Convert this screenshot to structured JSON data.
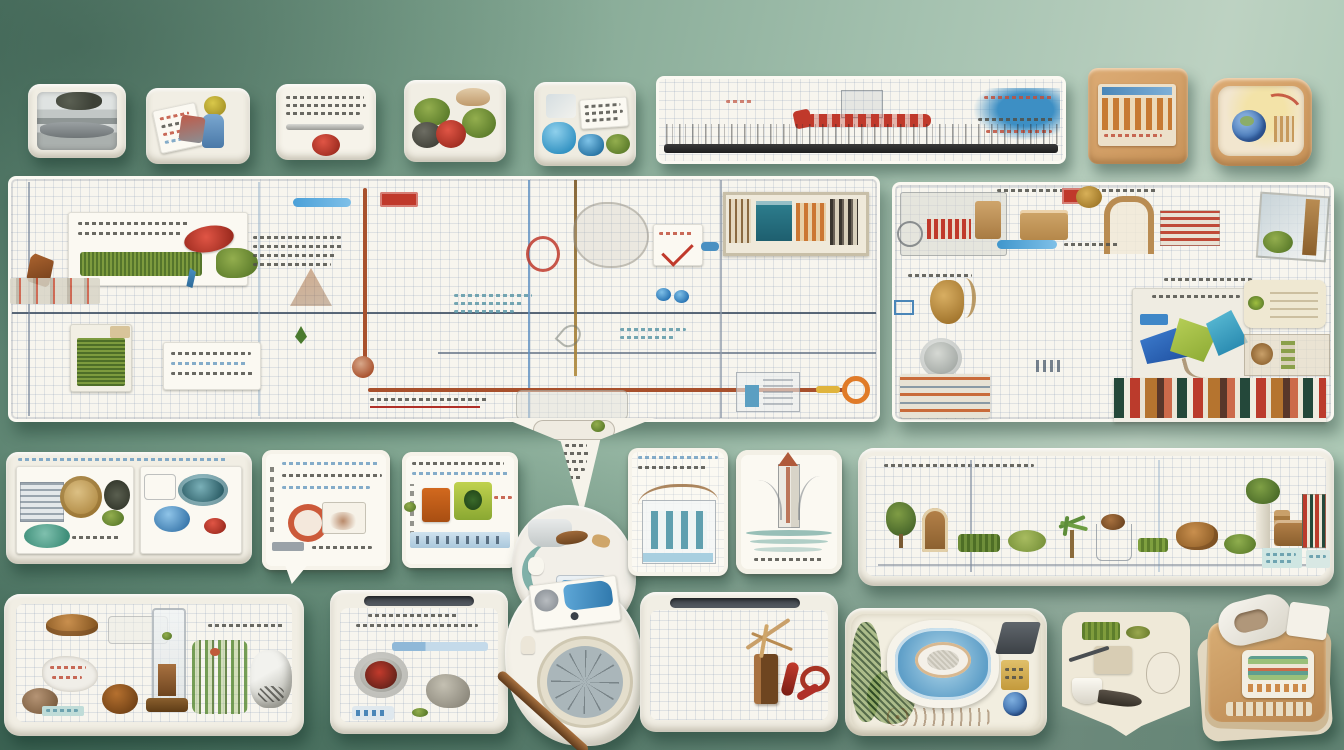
{
  "scene": {
    "type": "photographic still-life collage",
    "description": "White graph-paper boards and small display trays mounted on a sage-green wall; each tray holds miniature objects, moss, sketches and illegible printed gibberish text.",
    "background_colors": {
      "top_left": "#577e6c",
      "center": "#8fb29e",
      "right": "#bdd2c2",
      "bottom_shade": "#3f7561"
    },
    "legible_text": "none — all printed text in the photo is illegible gibberish"
  },
  "palette": {
    "paper": "#f7f5ee",
    "grid_line": "#aebdd4",
    "tray_rim": "#f1eee4",
    "tan_tray": "#d2a066",
    "accent_red": "#c0392b",
    "accent_rust": "#a8502c",
    "accent_blue": "#3f8fc4",
    "accent_navy": "#3e4f63",
    "accent_teal": "#2e7f8f",
    "moss_green": "#6e8e3a",
    "leaf_green": "#9fbf3f",
    "wood_brown": "#8a5a32"
  },
  "top_row": {
    "items": [
      {
        "name": "tray-stacked-prints",
        "description": "small white tray with a stack of grey newspaper-like prints and dark treetop imagery"
      },
      {
        "name": "tray-color-cards",
        "description": "white tray holding tilted colorful cards, a yellow tuft and a blue figurine"
      },
      {
        "name": "tray-note-red-ball",
        "description": "white tray with a printed gibberish note, a silver pen shape and a red yarn ball"
      },
      {
        "name": "tray-moss-cluster",
        "description": "white tray with green moss clumps, a red pom, a dark stone and a tan shell"
      },
      {
        "name": "tray-blue-crystals",
        "description": "white tray with blue crystal blobs, a labelled card of gibberish text and moss"
      },
      {
        "name": "ruler-board",
        "description": "long white grid board with red scribbles, a blue paint splash and a dark barcode strip"
      },
      {
        "name": "tan-tray-building",
        "description": "tan wooden tray showing an orange columned-building print with a blue header stripe"
      },
      {
        "name": "tan-tray-globe",
        "description": "tan rounded tray with a blue globe, yellow glow and red arcs"
      }
    ]
  },
  "main_board": {
    "left_panel": {
      "name": "graph-board-left",
      "description": "large white graph-paper board with navy rules, a rust-coloured pipe line, grass cards, printed gibberish blocks, sketches and a framed picture",
      "items": [
        {
          "name": "grass-card",
          "description": "white card with gibberish text, grass strip, red badge, moss fan and blue tassel"
        },
        {
          "name": "brown-bird",
          "description": "small brown bird-like shape at left edge"
        },
        {
          "name": "building-strip",
          "description": "faded strip of tiny building prints"
        },
        {
          "name": "text-block",
          "description": "block of illegible printed lines"
        },
        {
          "name": "blue-pill-marker",
          "description": "blue highlighted bar"
        },
        {
          "name": "red-stamp",
          "description": "small red stamped rectangle"
        },
        {
          "name": "grass-box",
          "description": "card with vertical green grass texture"
        },
        {
          "name": "text-card",
          "description": "white card with illegible printed lines"
        },
        {
          "name": "rust-pipe",
          "description": "rust-red pipe line running down then right with a knob and orange ring end"
        },
        {
          "name": "red-circle-sketch",
          "description": "hand-drawn red circle"
        },
        {
          "name": "tree-sketch",
          "description": "faint pencil tree sketch"
        },
        {
          "name": "speech-card",
          "description": "small card with red check scribble"
        },
        {
          "name": "framed-picture",
          "description": "framed collage with teal panel, orange figures and dark slats"
        },
        {
          "name": "blue-dots",
          "description": "two glossy blue paint dots"
        },
        {
          "name": "building-sketch",
          "description": "faint building outline with blue door"
        }
      ]
    },
    "pointer_tail": {
      "name": "board-pointer-tail",
      "description": "V-shaped paper tail hanging from the board bottom, filled with tiny sketches and a column of gibberish text"
    },
    "right_panel": {
      "name": "graph-board-right",
      "description": "second graph-paper board collaged with machine parts, boxes, a squirrel figure, a coin, geometric blue-green glass shards, shelves of tiny books and striped labels",
      "items": [
        {
          "name": "machine-collage",
          "description": "grey machine sketch with red grille"
        },
        {
          "name": "cardboard-box",
          "description": "small tan box"
        },
        {
          "name": "arch-frame",
          "description": "tan arched frame"
        },
        {
          "name": "striped-labels",
          "description": "red striped label cards"
        },
        {
          "name": "glass-moss-pane",
          "description": "tilted glass pane with green moss"
        },
        {
          "name": "gold-squirrel",
          "description": "small golden squirrel figure"
        },
        {
          "name": "grey-coin",
          "description": "round grey disc"
        },
        {
          "name": "striped-stack",
          "description": "stack of orange striped paper slips"
        },
        {
          "name": "geo-collage-card",
          "description": "card with cobalt, lime and teal triangular glass shards and gibberish title"
        },
        {
          "name": "cream-panel",
          "description": "cream rounded panel"
        },
        {
          "name": "mini-bookshelf",
          "description": "row of colourful miniature book spines"
        }
      ]
    }
  },
  "middle_row": {
    "items": [
      {
        "name": "wide-diorama-tray",
        "description": "wide tray split in two panels: building print, gold disc, dark bush and teal oval; teal bowl, blue egg and red pom"
      },
      {
        "name": "speech-card-tray",
        "description": "speech-bubble card with blue gibberish lines, an orange ring and a white box"
      },
      {
        "name": "sticker-card-tray",
        "description": "card with gibberish lines, orange and green stickers and a pale blue band of figures"
      },
      {
        "name": "blob-dish",
        "description": "irregular white dish with teal curve, sink shapes, a brown fish and a blue-painted box"
      },
      {
        "name": "building-card-tray",
        "description": "grid card with a teal-columned building sketch under a brown wavy line"
      },
      {
        "name": "tower-card-tray",
        "description": "card with a sketched tower, red tip and teal water waves"
      },
      {
        "name": "long-miniatures-tray",
        "description": "long grid tray with a row of miniatures: topiary, arched cabinet, hedge trays, palm, baskets, bread, potted plant, suitcase and tiny books"
      }
    ]
  },
  "bottom_row": {
    "items": [
      {
        "name": "grid-tray-specimens",
        "description": "grid tray with bread shape, wrapped candies, stones, a tall glass tube with brown sediment, ferns and a crystalline sack"
      },
      {
        "name": "grid-tray-cup",
        "description": "grid tray with handle notch, gibberish title, blue bar, a metal cup with red jam, a grey stone and a capsule strip"
      },
      {
        "name": "paper-blob-wheel",
        "description": "torn white paper piece with blue-painted card, a woven wheel and a long brown stick"
      },
      {
        "name": "grid-tray-wood",
        "description": "grid tray with handle notch, a wooden block, dried sprigs and red chili curls"
      },
      {
        "name": "terrain-tray",
        "description": "cream tray with green mesh foliage, a blue stadium bowl with white oval field, a dark wedge, yellow packets and a blue sphere"
      },
      {
        "name": "cup-fish-tray",
        "description": "pointed cream tray with moss bricks, a white cup and a dark fish shape"
      },
      {
        "name": "stacked-binders",
        "description": "stack of tan cards and striped notebooks with a white curved handle"
      }
    ]
  }
}
